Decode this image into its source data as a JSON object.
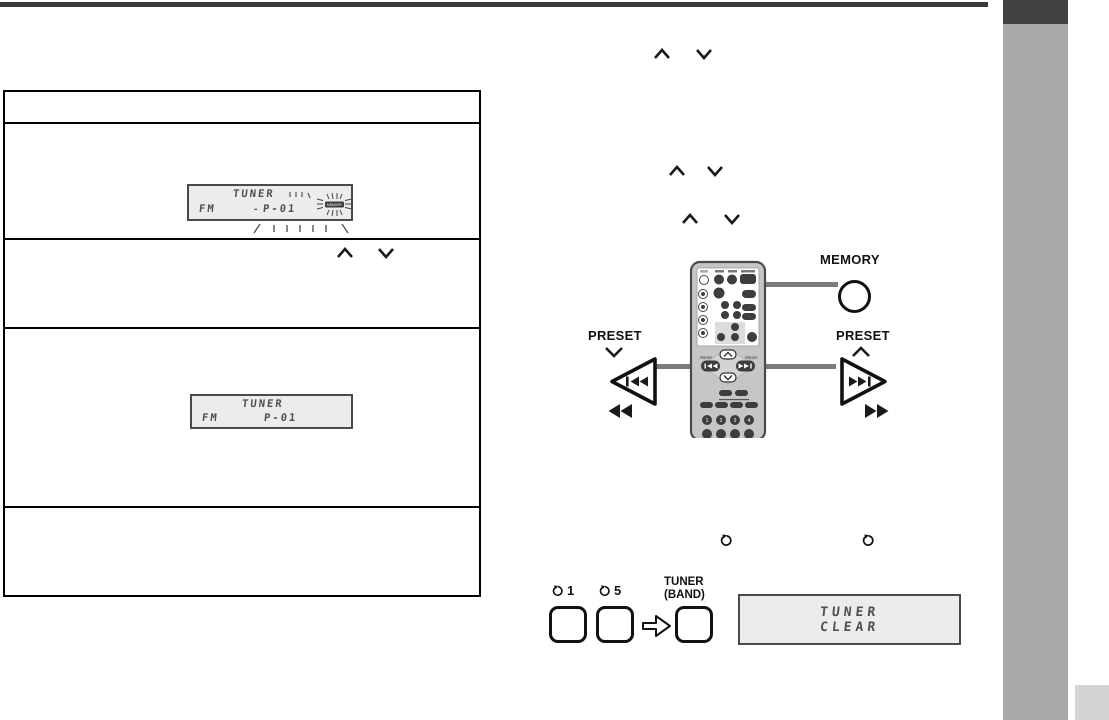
{
  "colors": {
    "top_rule": "#3a3a3a",
    "sidebar": "#a9a9a9",
    "sidebar_tab": "#414141",
    "page_corner": "#d4d4d4",
    "lcd_background": "#ececec",
    "lcd_text": "#4f4f4f",
    "callout_line": "#7c7c7c",
    "button_dark": "#3d3d3d"
  },
  "lcd": {
    "blinking_preset": {
      "source": "TUNER",
      "band": "FM",
      "preset": "P-01",
      "indicator": "MEMORY"
    },
    "stored_preset": {
      "source": "TUNER",
      "band": "FM",
      "preset": "P-01"
    },
    "clear": {
      "line1": "TUNER",
      "line2": "CLEAR"
    }
  },
  "callouts": {
    "memory_label": "MEMORY",
    "preset_down_label": "PRESET",
    "preset_up_label": "PRESET",
    "skip_back_glyph": "◀◀",
    "skip_forward_glyph": "▶▶",
    "rewind_glyph": "◀◀",
    "fast_forward_glyph": "▶▶"
  },
  "clear_procedure": {
    "button1_label": "1",
    "button5_label": "5",
    "tuner_band_label_line1": "TUNER",
    "tuner_band_label_line2": "(BAND)"
  },
  "remote": {
    "digits": [
      "1",
      "2",
      "3",
      "4"
    ],
    "preset_left_small": "PRESET",
    "preset_right_small": "PRESET"
  }
}
